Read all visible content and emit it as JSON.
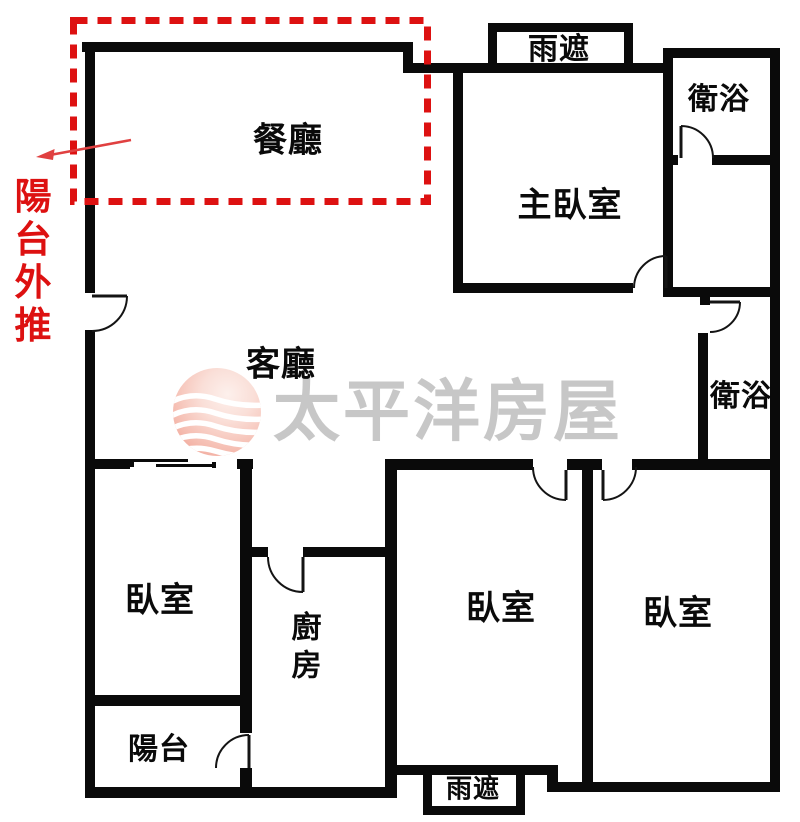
{
  "plan": {
    "annotation": {
      "balcony_note": "陽台外推",
      "note_color": "#dd1111"
    },
    "rooms": {
      "dining": "餐廳",
      "living": "客廳",
      "master_bedroom": "主臥室",
      "bathroom_top": "衛浴",
      "bathroom_mid": "衛浴",
      "bedroom_left": "臥室",
      "bedroom_mid": "臥室",
      "bedroom_right": "臥室",
      "kitchen": "廚房",
      "balcony": "陽台",
      "rain_cover_top": "雨遮",
      "rain_cover_bottom": "雨遮"
    },
    "colors": {
      "wall": "#0a0a0a",
      "annotation_red": "#dd1111",
      "watermark_gray": "#c5c5c5",
      "logo_pink": "#f2a99c",
      "background": "#ffffff"
    }
  },
  "watermark": {
    "brand": "太平洋房屋"
  }
}
